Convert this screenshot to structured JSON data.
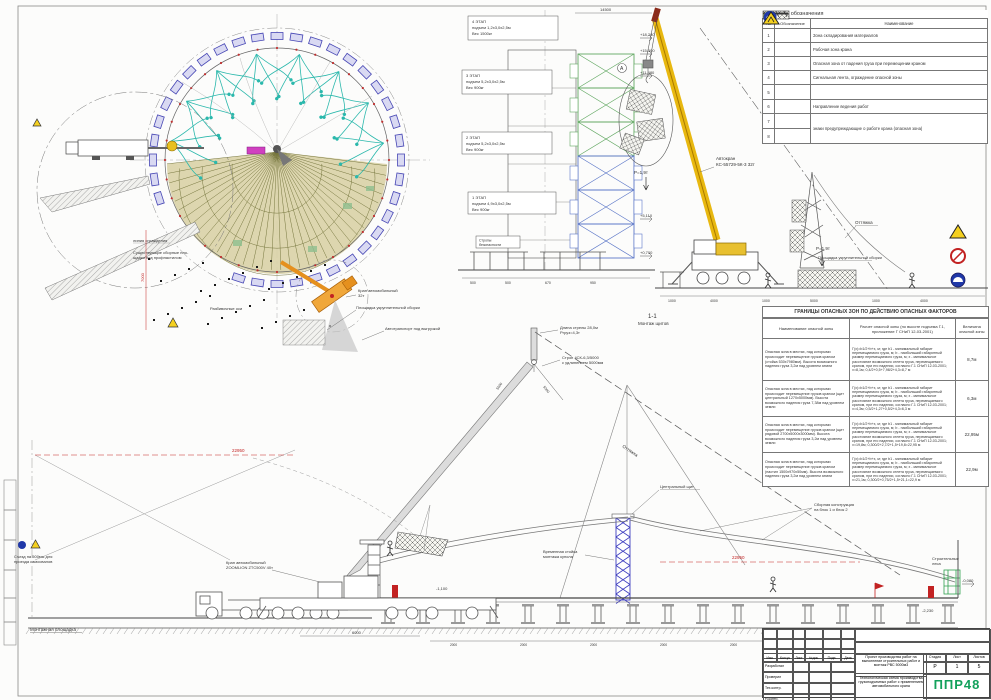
{
  "legend": {
    "title": "Условные обозначения",
    "cols": {
      "no": "№",
      "symbol": "Обозначение",
      "name": "Наименование"
    },
    "rows": [
      {
        "no": "1",
        "name": "Зона складирования материалов"
      },
      {
        "no": "2",
        "name": "Рабочая зона крана"
      },
      {
        "no": "3",
        "name": "Опасная зона от падения груза при перемещении краном"
      },
      {
        "no": "4",
        "name": "Сигнальная лента, ограждение опасной зоны"
      },
      {
        "no": "5",
        "name": ""
      },
      {
        "no": "6",
        "name": "Направление ведения работ"
      },
      {
        "no": "7",
        "name": "знаки предупреждающие о работе крана (опасная зона)"
      },
      {
        "no": "8",
        "name": ""
      }
    ]
  },
  "danger_table": {
    "title": "ГРАНИЦЫ ОПАСНЫХ ЗОН ПО ДЕЙСТВИЮ ОПАСНЫХ ФАКТОРОВ",
    "cols": {
      "zone": "Наименование опасной зоны",
      "calc": "Расчет опасной зоны (по высоте подъема Г.1, приложение Г СНиП 12-03-2001)",
      "value": "Величина опасной зоны"
    },
    "rows": [
      {
        "zone": "Опасная зона в местах, над которыми происходит перемещение грузов краном (стойка 530х7980мм). Высота возможного падения груза 3,2м над уровнем земли",
        "calc": "Г(х)=b1/2+b+х, м; где b1 - минимальный габарит перемещаемого груза, м; b - наибольший габаритный размер перемещаемого груза, м; х - минимальное расстояние возможного отлета груза, перемещаемого краном, при его падении, согласно Г.1 СНиП 12-03-2001; х=8,1м; 0,4/2+0,5+7,98/2+4,3=8,7 м",
        "value": "8,7м"
      },
      {
        "zone": "Опасная зона в местах, над которыми происходит перемещение грузов краном (щит центральный 1270х5000мм). Высота возможного падения груза 7,38м над уровнем земли",
        "calc": "Г(х)=b1/2+b+х, м; где b1 - минимальный габарит перемещаемого груза, м; b - наибольший габаритный размер перемещаемого груза, м; х - минимальное расстояние возможного отлета груза, перемещаемого краном, при его падении, согласно Г.1 СНиП 12-03-2001; х=4,3м; 0,5/2+1,27+0,5/2+4,3=6,3 м",
        "value": "6,3м"
      },
      {
        "zone": "Опасная зона в местах, над которыми происходит перемещение грузов краном (щит рядовой 2700х5000х3000мм). Высота возможного падения груза 3,2м над уровнем земли",
        "calc": "Г(х)=b1/2+b+х, м; где b1 - минимальный габарит перемещаемого груза, м; b - наибольший габаритный размер перемещаемого груза, м; х - минимальное расстояние возможного отлета груза, перемещаемого краном, при его падении, согласно Г.1 СНиП 12-03-2001; х=19,8м; 0,300/2+2,7/2+1,5+19,8=22,95 м",
        "value": "22,95м"
      },
      {
        "zone": "Опасная зона в местах, над которыми происходит перемещение грузов краном (настил 1500х970х50мм). Высота возможного падения груза 3,2м над уровнем земли",
        "calc": "Г(х)=b1/2+b+х, м; где b1 - минимальный габарит перемещаемого груза, м; b - наибольший габаритный размер перемещаемого груза, м; х - минимальное расстояние возможного отлета груза, перемещаемого краном, при его падении, согласно Г.1 СНиП 12-03-2001; х=21,1м; 0,300/2+0,75/2+1,5+21,1=22,9 м",
        "value": "22,9м"
      }
    ]
  },
  "title_block": {
    "sig_cols": [
      "Изм.",
      "Кол.уч",
      "Лист",
      "№док.",
      "Подп.",
      "Дата"
    ],
    "roles": [
      "Разработал",
      "Проверил",
      "Тех.контр.",
      "Н.контр."
    ],
    "doc_title": "Проект производства работ на выполнение строительных работ и монтаж РВС 5000м3",
    "scheme_title": "Технологическая схема производства грузоподъемных работ с применением автомобильного крана",
    "stage_label": "Стадия",
    "sheet_label": "Лист",
    "sheets_label": "Листов",
    "stage": "Р",
    "sheet": "1",
    "sheets": "5",
    "logo": "ППР48"
  },
  "plan": {
    "crane_plan1": "Кран автомобильный",
    "crane_plan2": "32т",
    "assembly_area": "Площадка укрупнительной сборки",
    "transport": "Автотранспорт под выгрузкой",
    "fence": "линия ограждения",
    "existing1": "Существующие сборные пло-",
    "existing2": "щадки под профнастилом",
    "axes": "Разбивочные оси",
    "mount_site": "Монтажная площадка",
    "ramp1": "Съезд на 500мм для",
    "ramp2": "проезда самосвалов"
  },
  "elevation": {
    "stage4a": "4 ЭТАП",
    "stage4b": "подъем 1,2х3,0х2,5м",
    "stage4c": "Вес 1500кг",
    "stage3a": "3 ЭТАП",
    "stage3b": "подъем 5,2х3,0х2,5м",
    "stage3c": "Вес 900кг",
    "stage2a": "2 ЭТАП",
    "stage2b": "подъем 5,2х3,0х2,5м",
    "stage2c": "Вес 900кг",
    "stage1a": "1 ЭТАП",
    "stage1b": "подъем 4,9х3,0х2,5м",
    "stage1c": "Вес 900кг",
    "safety1": "Стропы",
    "safety2": "безопасности",
    "marks": [
      "+18,280",
      "+15,500",
      "+11,480",
      "+5,110",
      "+0,700"
    ],
    "chain": [
      "500",
      "500",
      "670",
      "950"
    ]
  },
  "crane": {
    "label1": "Автокран",
    "label2": "КС-55729-5К-3 32т",
    "load": "Р=1,9т",
    "hook_mark": "А",
    "guy": "Оттяжка",
    "chain": [
      "1000",
      "4000",
      "1000",
      "5000",
      "1000",
      "4000"
    ]
  },
  "section": {
    "title1": "1-1",
    "title2": "Монтаж щитов",
    "boom_len": "Длина стрелы 28,0м",
    "load_radius": "Ргруз=4,3т",
    "sling1": "Строп 4СК-6,3/5000",
    "sling2": "с удлинением 5000мм",
    "central": "Центральный щит",
    "temp1": "Временная стойка",
    "temp2": "монтажа купола",
    "precast1": "Сборная конструкция",
    "precast2": "на блок 1 и блок 2",
    "scaffold1": "Строительные",
    "scaffold2": "леса",
    "crane_bottom1": "Кран автомобильный",
    "crane_bottom2": "ZOOMLION ZTC500V 40т"
  },
  "dims": {
    "top": "14500",
    "red_left": "22950",
    "red_right": "22950",
    "v7000": "7000",
    "d6000": "6000",
    "d5000": "5000",
    "deck_step": "2000",
    "mark_a": "-0,080",
    "mark_b": "-2,230",
    "mark_c": "-1,100"
  }
}
